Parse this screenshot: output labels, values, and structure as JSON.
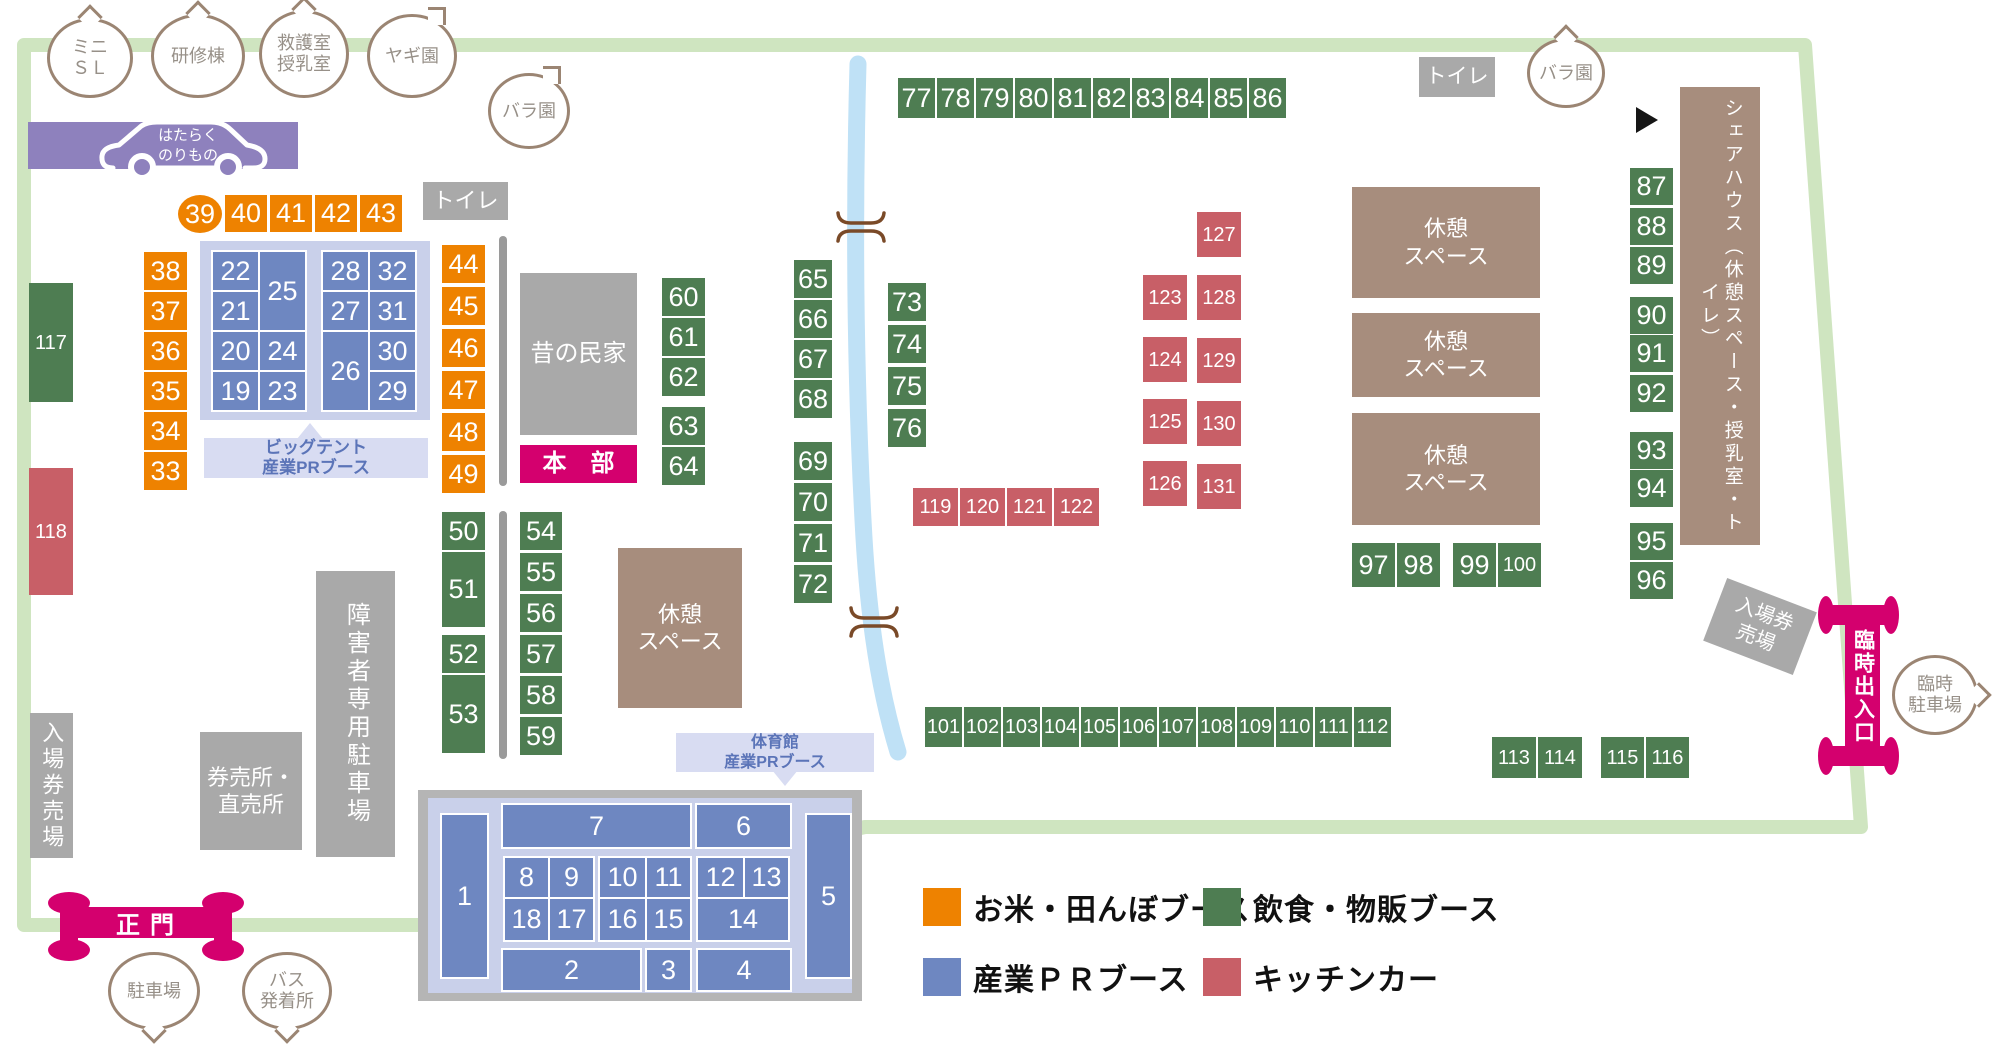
{
  "colors": {
    "orange": "#ee8200",
    "green": "#4e7d52",
    "blue": "#6e87c1",
    "red": "#c85f67",
    "pink": "#d4006e",
    "brown": "#a78d7d",
    "purple": "#8e81bd",
    "border_green": "#cfe5c0",
    "river_blue": "#bfe1f6"
  },
  "legend": {
    "items": [
      {
        "key": "orange",
        "label": "お米・田んぼブース",
        "x": 923,
        "y": 888
      },
      {
        "key": "green",
        "label": "飲食・物販ブース",
        "x": 1203,
        "y": 888
      },
      {
        "key": "blue",
        "label": "産業ＰＲブース",
        "x": 923,
        "y": 958
      },
      {
        "key": "red",
        "label": "キッチンカー",
        "x": 1203,
        "y": 958
      }
    ]
  },
  "gates": {
    "main_gate": "正門",
    "temp_gate": "臨時出入口"
  },
  "banner": {
    "text": "はたらく\nのりもの"
  },
  "areas": [
    {
      "name": "toilet-left",
      "text": "トイレ",
      "x": 423,
      "y": 182,
      "w": 85,
      "h": 38,
      "cls": "gray",
      "fs": 22
    },
    {
      "name": "toilet-right",
      "text": "トイレ",
      "x": 1419,
      "y": 57,
      "w": 76,
      "h": 40,
      "cls": "gray",
      "fs": 21
    },
    {
      "name": "old-folk-house",
      "text": "昔の民家",
      "x": 520,
      "y": 273,
      "w": 117,
      "h": 162,
      "cls": "gray",
      "fs": 24
    },
    {
      "name": "headquarters",
      "text": "本　部",
      "x": 520,
      "y": 445,
      "w": 117,
      "h": 38,
      "cls": "pink",
      "fs": 24
    },
    {
      "name": "rest-space-1",
      "text": "休憩\nスペース",
      "x": 618,
      "y": 548,
      "w": 124,
      "h": 160,
      "cls": "brown",
      "fs": 22
    },
    {
      "name": "rest-space-2",
      "text": "休憩\nスペース",
      "x": 1352,
      "y": 187,
      "w": 188,
      "h": 111,
      "cls": "brown",
      "fs": 22
    },
    {
      "name": "rest-space-3",
      "text": "休憩\nスペース",
      "x": 1352,
      "y": 313,
      "w": 188,
      "h": 84,
      "cls": "brown",
      "fs": 22
    },
    {
      "name": "rest-space-4",
      "text": "休憩\nスペース",
      "x": 1352,
      "y": 413,
      "w": 188,
      "h": 112,
      "cls": "brown",
      "fs": 22
    },
    {
      "name": "share-house",
      "text": "シェアハウス（休憩スペース・授乳室・トイレ）",
      "x": 1680,
      "y": 87,
      "w": 80,
      "h": 458,
      "cls": "brown",
      "fs": 19,
      "vert": true
    },
    {
      "name": "ticket-booth-left",
      "text": "入場券売場",
      "x": 30,
      "y": 713,
      "w": 43,
      "h": 145,
      "cls": "gray",
      "fs": 22,
      "vert": true
    },
    {
      "name": "ticket-direct-sales",
      "text": "券売所・\n直売所",
      "x": 200,
      "y": 732,
      "w": 102,
      "h": 118,
      "cls": "gray",
      "fs": 22
    },
    {
      "name": "disabled-parking",
      "text": "障害者専用駐車場",
      "x": 316,
      "y": 571,
      "w": 79,
      "h": 286,
      "cls": "gray",
      "fs": 24,
      "vert": true
    },
    {
      "name": "ticket-booth-right",
      "text": "入場券\n売場",
      "x": 1712,
      "y": 593,
      "w": 96,
      "h": 67,
      "cls": "gray",
      "fs": 20,
      "rot": 21
    },
    {
      "name": "big-tent-label",
      "text": "ビッグテント\n産業PRブース",
      "x": 204,
      "y": 438,
      "w": 224,
      "h": 40,
      "cls": "lbl",
      "fs": 17
    },
    {
      "name": "gym-label",
      "text": "体育館\n産業PRブース",
      "x": 676,
      "y": 733,
      "w": 198,
      "h": 39,
      "cls": "lbl",
      "fs": 16
    }
  ],
  "bubbles": [
    {
      "name": "mini-sl",
      "text": "ミニ\nＳＬ",
      "cx": 90,
      "cy": 58,
      "rx": 43,
      "ry": 40,
      "tail": "up"
    },
    {
      "name": "training-bldg",
      "text": "研修棟",
      "cx": 198,
      "cy": 56,
      "rx": 47,
      "ry": 42,
      "tail": "up"
    },
    {
      "name": "first-aid-nursing",
      "text": "救護室\n授乳室",
      "cx": 304,
      "cy": 54,
      "rx": 45,
      "ry": 44,
      "tail": "up"
    },
    {
      "name": "goat-garden",
      "text": "ヤギ園",
      "cx": 412,
      "cy": 56,
      "rx": 45,
      "ry": 42,
      "tail": "upright"
    },
    {
      "name": "rose-garden-left",
      "text": "バラ園",
      "cx": 529,
      "cy": 111,
      "rx": 41,
      "ry": 38,
      "tail": "upright"
    },
    {
      "name": "rose-garden-right",
      "text": "バラ園",
      "cx": 1566,
      "cy": 73,
      "rx": 39,
      "ry": 35,
      "tail": "up"
    },
    {
      "name": "temp-parking",
      "text": "臨時\n駐車場",
      "cx": 1935,
      "cy": 695,
      "rx": 43,
      "ry": 40,
      "tail": "right"
    },
    {
      "name": "parking",
      "text": "駐車場",
      "cx": 154,
      "cy": 991,
      "rx": 46,
      "ry": 39,
      "tail": "down"
    },
    {
      "name": "bus-terminal",
      "text": "バス\n発着所",
      "cx": 287,
      "cy": 991,
      "rx": 45,
      "ry": 39,
      "tail": "down"
    }
  ],
  "booth_groups": [
    {
      "name": "rice-booth-39",
      "color": "orange",
      "shape": "ellipse",
      "x": 178,
      "y": 195,
      "cells": [
        {
          "n": 39,
          "x": 0,
          "y": 0,
          "w": 44,
          "h": 38
        }
      ]
    },
    {
      "name": "rice-row-40-43",
      "color": "orange",
      "x": 225,
      "y": 195,
      "cw": 42,
      "ch": 37,
      "dx": 45,
      "dy": 0,
      "nums": [
        40,
        41,
        42,
        43
      ]
    },
    {
      "name": "rice-col-33-38",
      "color": "orange",
      "x": 144,
      "y": 252,
      "cw": 43,
      "ch": 38,
      "dx": 0,
      "dy": 40,
      "nums": [
        38,
        37,
        36,
        35,
        34,
        33
      ]
    },
    {
      "name": "rice-col-44-49",
      "color": "orange",
      "x": 442,
      "y": 245,
      "cw": 43,
      "ch": 38,
      "dx": 0,
      "dy": 42,
      "nums": [
        44,
        45,
        46,
        47,
        48,
        49
      ]
    },
    {
      "name": "big-tent-booths",
      "color": "blue",
      "x": 200,
      "y": 241,
      "cells": [
        {
          "n": 22,
          "x": 13,
          "y": 11,
          "w": 45,
          "h": 38
        },
        {
          "n": 25,
          "x": 60,
          "y": 11,
          "w": 45,
          "h": 78
        },
        {
          "n": 21,
          "x": 13,
          "y": 51,
          "w": 45,
          "h": 38
        },
        {
          "n": 20,
          "x": 13,
          "y": 91,
          "w": 45,
          "h": 38
        },
        {
          "n": 24,
          "x": 60,
          "y": 91,
          "w": 45,
          "h": 38
        },
        {
          "n": 19,
          "x": 13,
          "y": 131,
          "w": 45,
          "h": 38
        },
        {
          "n": 23,
          "x": 60,
          "y": 131,
          "w": 45,
          "h": 38
        },
        {
          "n": 28,
          "x": 123,
          "y": 11,
          "w": 45,
          "h": 38
        },
        {
          "n": 32,
          "x": 170,
          "y": 11,
          "w": 45,
          "h": 38
        },
        {
          "n": 27,
          "x": 123,
          "y": 51,
          "w": 45,
          "h": 38
        },
        {
          "n": 31,
          "x": 170,
          "y": 51,
          "w": 45,
          "h": 38
        },
        {
          "n": 26,
          "x": 123,
          "y": 91,
          "w": 45,
          "h": 78
        },
        {
          "n": 30,
          "x": 170,
          "y": 91,
          "w": 45,
          "h": 38
        },
        {
          "n": 29,
          "x": 170,
          "y": 131,
          "w": 45,
          "h": 38
        }
      ]
    },
    {
      "name": "gym-booths",
      "color": "blue",
      "x": 418,
      "y": 790,
      "cells": [
        {
          "n": 1,
          "x": 24,
          "y": 25,
          "w": 45,
          "h": 162
        },
        {
          "n": 7,
          "x": 85,
          "y": 15,
          "w": 187,
          "h": 42
        },
        {
          "n": 6,
          "x": 279,
          "y": 15,
          "w": 93,
          "h": 42
        },
        {
          "n": 5,
          "x": 389,
          "y": 25,
          "w": 43,
          "h": 162
        },
        {
          "n": 8,
          "x": 87,
          "y": 68,
          "w": 43,
          "h": 39
        },
        {
          "n": 9,
          "x": 132,
          "y": 68,
          "w": 43,
          "h": 39
        },
        {
          "n": 10,
          "x": 182,
          "y": 68,
          "w": 45,
          "h": 39
        },
        {
          "n": 11,
          "x": 229,
          "y": 68,
          "w": 43,
          "h": 39
        },
        {
          "n": 12,
          "x": 280,
          "y": 68,
          "w": 45,
          "h": 39
        },
        {
          "n": 13,
          "x": 327,
          "y": 68,
          "w": 43,
          "h": 39
        },
        {
          "n": 18,
          "x": 87,
          "y": 109,
          "w": 43,
          "h": 41
        },
        {
          "n": 17,
          "x": 132,
          "y": 109,
          "w": 43,
          "h": 41
        },
        {
          "n": 16,
          "x": 182,
          "y": 109,
          "w": 45,
          "h": 41
        },
        {
          "n": 15,
          "x": 229,
          "y": 109,
          "w": 43,
          "h": 41
        },
        {
          "n": 14,
          "x": 280,
          "y": 109,
          "w": 90,
          "h": 41
        },
        {
          "n": 2,
          "x": 85,
          "y": 160,
          "w": 137,
          "h": 40
        },
        {
          "n": 3,
          "x": 229,
          "y": 160,
          "w": 43,
          "h": 40
        },
        {
          "n": 4,
          "x": 280,
          "y": 160,
          "w": 92,
          "h": 40
        }
      ]
    },
    {
      "name": "food-col-50-53",
      "color": "green",
      "x": 442,
      "y": 512,
      "cells": [
        {
          "n": 50,
          "x": 0,
          "y": 0,
          "w": 43,
          "h": 38
        },
        {
          "n": 51,
          "x": 0,
          "y": 40,
          "w": 43,
          "h": 75
        },
        {
          "n": 52,
          "x": 0,
          "y": 123,
          "w": 43,
          "h": 38
        },
        {
          "n": 53,
          "x": 0,
          "y": 163,
          "w": 43,
          "h": 78
        }
      ]
    },
    {
      "name": "food-col-54-59",
      "color": "green",
      "x": 520,
      "y": 512,
      "cw": 42,
      "ch": 38,
      "dx": 0,
      "dy": 41,
      "nums": [
        54,
        55,
        56,
        57,
        58,
        59
      ]
    },
    {
      "name": "food-col-60-64",
      "color": "green",
      "x": 662,
      "y": 278,
      "cells": [
        {
          "n": 60,
          "x": 0,
          "y": 0,
          "w": 43,
          "h": 38
        },
        {
          "n": 61,
          "x": 0,
          "y": 40,
          "w": 43,
          "h": 38
        },
        {
          "n": 62,
          "x": 0,
          "y": 80,
          "w": 43,
          "h": 38
        },
        {
          "n": 63,
          "x": 0,
          "y": 129,
          "w": 43,
          "h": 38
        },
        {
          "n": 64,
          "x": 0,
          "y": 169,
          "w": 43,
          "h": 38
        }
      ]
    },
    {
      "name": "food-col-65-68",
      "color": "green",
      "x": 794,
      "y": 260,
      "cw": 38,
      "ch": 38,
      "dx": 0,
      "dy": 40,
      "nums": [
        65,
        66,
        67,
        68
      ]
    },
    {
      "name": "food-col-69-72",
      "color": "green",
      "x": 794,
      "y": 442,
      "cw": 38,
      "ch": 38,
      "dx": 0,
      "dy": 41,
      "nums": [
        69,
        70,
        71,
        72
      ]
    },
    {
      "name": "food-col-73-76",
      "color": "green",
      "x": 888,
      "y": 283,
      "cw": 38,
      "ch": 38,
      "dx": 0,
      "dy": 42,
      "nums": [
        73,
        74,
        75,
        76
      ]
    },
    {
      "name": "food-row-77-86",
      "color": "green",
      "x": 898,
      "y": 78,
      "cw": 37,
      "ch": 40,
      "dx": 39,
      "dy": 0,
      "nums": [
        77,
        78,
        79,
        80,
        81,
        82,
        83,
        84,
        85,
        86
      ]
    },
    {
      "name": "food-col-87-96",
      "color": "green",
      "x": 1630,
      "y": 168,
      "cells": [
        {
          "n": 87,
          "x": 0,
          "y": 0,
          "w": 43,
          "h": 37
        },
        {
          "n": 88,
          "x": 0,
          "y": 40,
          "w": 43,
          "h": 37
        },
        {
          "n": 89,
          "x": 0,
          "y": 79,
          "w": 43,
          "h": 37
        },
        {
          "n": 90,
          "x": 0,
          "y": 129,
          "w": 43,
          "h": 37
        },
        {
          "n": 91,
          "x": 0,
          "y": 167,
          "w": 43,
          "h": 37
        },
        {
          "n": 92,
          "x": 0,
          "y": 207,
          "w": 43,
          "h": 37
        },
        {
          "n": 93,
          "x": 0,
          "y": 264,
          "w": 43,
          "h": 37
        },
        {
          "n": 94,
          "x": 0,
          "y": 302,
          "w": 43,
          "h": 37
        },
        {
          "n": 95,
          "x": 0,
          "y": 355,
          "w": 43,
          "h": 37
        },
        {
          "n": 96,
          "x": 0,
          "y": 394,
          "w": 43,
          "h": 37
        }
      ]
    },
    {
      "name": "food-row-97-100",
      "color": "green",
      "x": 1352,
      "y": 543,
      "cells": [
        {
          "n": 97,
          "x": 0,
          "y": 0,
          "w": 43,
          "h": 44
        },
        {
          "n": 98,
          "x": 45,
          "y": 0,
          "w": 43,
          "h": 44
        },
        {
          "n": 99,
          "x": 101,
          "y": 0,
          "w": 43,
          "h": 44
        },
        {
          "n": 100,
          "x": 146,
          "y": 0,
          "w": 43,
          "h": 44
        }
      ]
    },
    {
      "name": "food-row-101-112",
      "color": "green",
      "x": 925,
      "y": 707,
      "cw": 37,
      "ch": 40,
      "dx": 39,
      "dy": 0,
      "nums": [
        101,
        102,
        103,
        104,
        105,
        106,
        107,
        108,
        109,
        110,
        111,
        112
      ]
    },
    {
      "name": "food-row-113-114",
      "color": "green",
      "x": 1492,
      "y": 737,
      "cw": 44,
      "ch": 41,
      "dx": 46,
      "dy": 0,
      "nums": [
        113,
        114
      ]
    },
    {
      "name": "food-row-115-116",
      "color": "green",
      "x": 1601,
      "y": 737,
      "cw": 43,
      "ch": 41,
      "dx": 45,
      "dy": 0,
      "nums": [
        115,
        116
      ]
    },
    {
      "name": "food-booth-117",
      "color": "green",
      "x": 29,
      "y": 283,
      "cells": [
        {
          "n": 117,
          "x": 0,
          "y": 0,
          "w": 44,
          "h": 119
        }
      ]
    },
    {
      "name": "kitchen-booth-118",
      "color": "red",
      "x": 29,
      "y": 468,
      "cells": [
        {
          "n": 118,
          "x": 0,
          "y": 0,
          "w": 44,
          "h": 127
        }
      ]
    },
    {
      "name": "kitchen-row-119-122",
      "color": "red",
      "x": 913,
      "y": 488,
      "cw": 45,
      "ch": 38,
      "dx": 47,
      "dy": 0,
      "nums": [
        119,
        120,
        121,
        122
      ]
    },
    {
      "name": "kitchen-col-123-126",
      "color": "red",
      "x": 1143,
      "y": 275,
      "cw": 44,
      "ch": 45,
      "dx": 0,
      "dy": 62,
      "nums": [
        123,
        124,
        125,
        126
      ]
    },
    {
      "name": "kitchen-col-127-131",
      "color": "red",
      "x": 1197,
      "y": 212,
      "cw": 44,
      "ch": 45,
      "dx": 0,
      "dy": 63,
      "nums": [
        127,
        128,
        129,
        130,
        131
      ]
    }
  ]
}
